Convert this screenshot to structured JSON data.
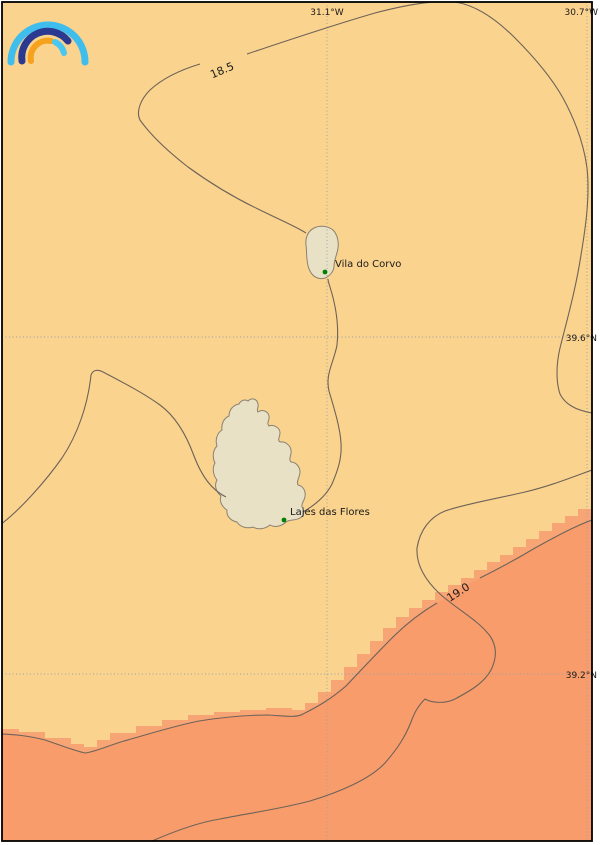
{
  "map": {
    "graticule": {
      "meridians": [
        {
          "label": "31.1°W"
        },
        {
          "label": "30.7°W"
        }
      ],
      "parallels": [
        {
          "label": "39.6°N"
        },
        {
          "label": "39.2°N"
        }
      ]
    },
    "isotherms": [
      {
        "level": "18.5"
      },
      {
        "level": "19.0"
      }
    ],
    "places": [
      {
        "name": "Vila do Corvo"
      },
      {
        "name": "Lajes das Flores"
      }
    ],
    "colors": {
      "sea_cool": "#FAD38E",
      "sea_warm": "#F89C6C",
      "sea_warm_fringe": "#F8A576",
      "island_fill": "#E9E1C6",
      "island_outline": "#8A8172",
      "contour": "#6E6358",
      "graticule": "#95A0AC",
      "place_dot": "#008000",
      "border": "#000000",
      "logo_outer_blue": "#3FBDEC",
      "logo_navy": "#2B3990",
      "logo_orange": "#F6A21C",
      "logo_light_blue": "#49C7F3"
    }
  }
}
